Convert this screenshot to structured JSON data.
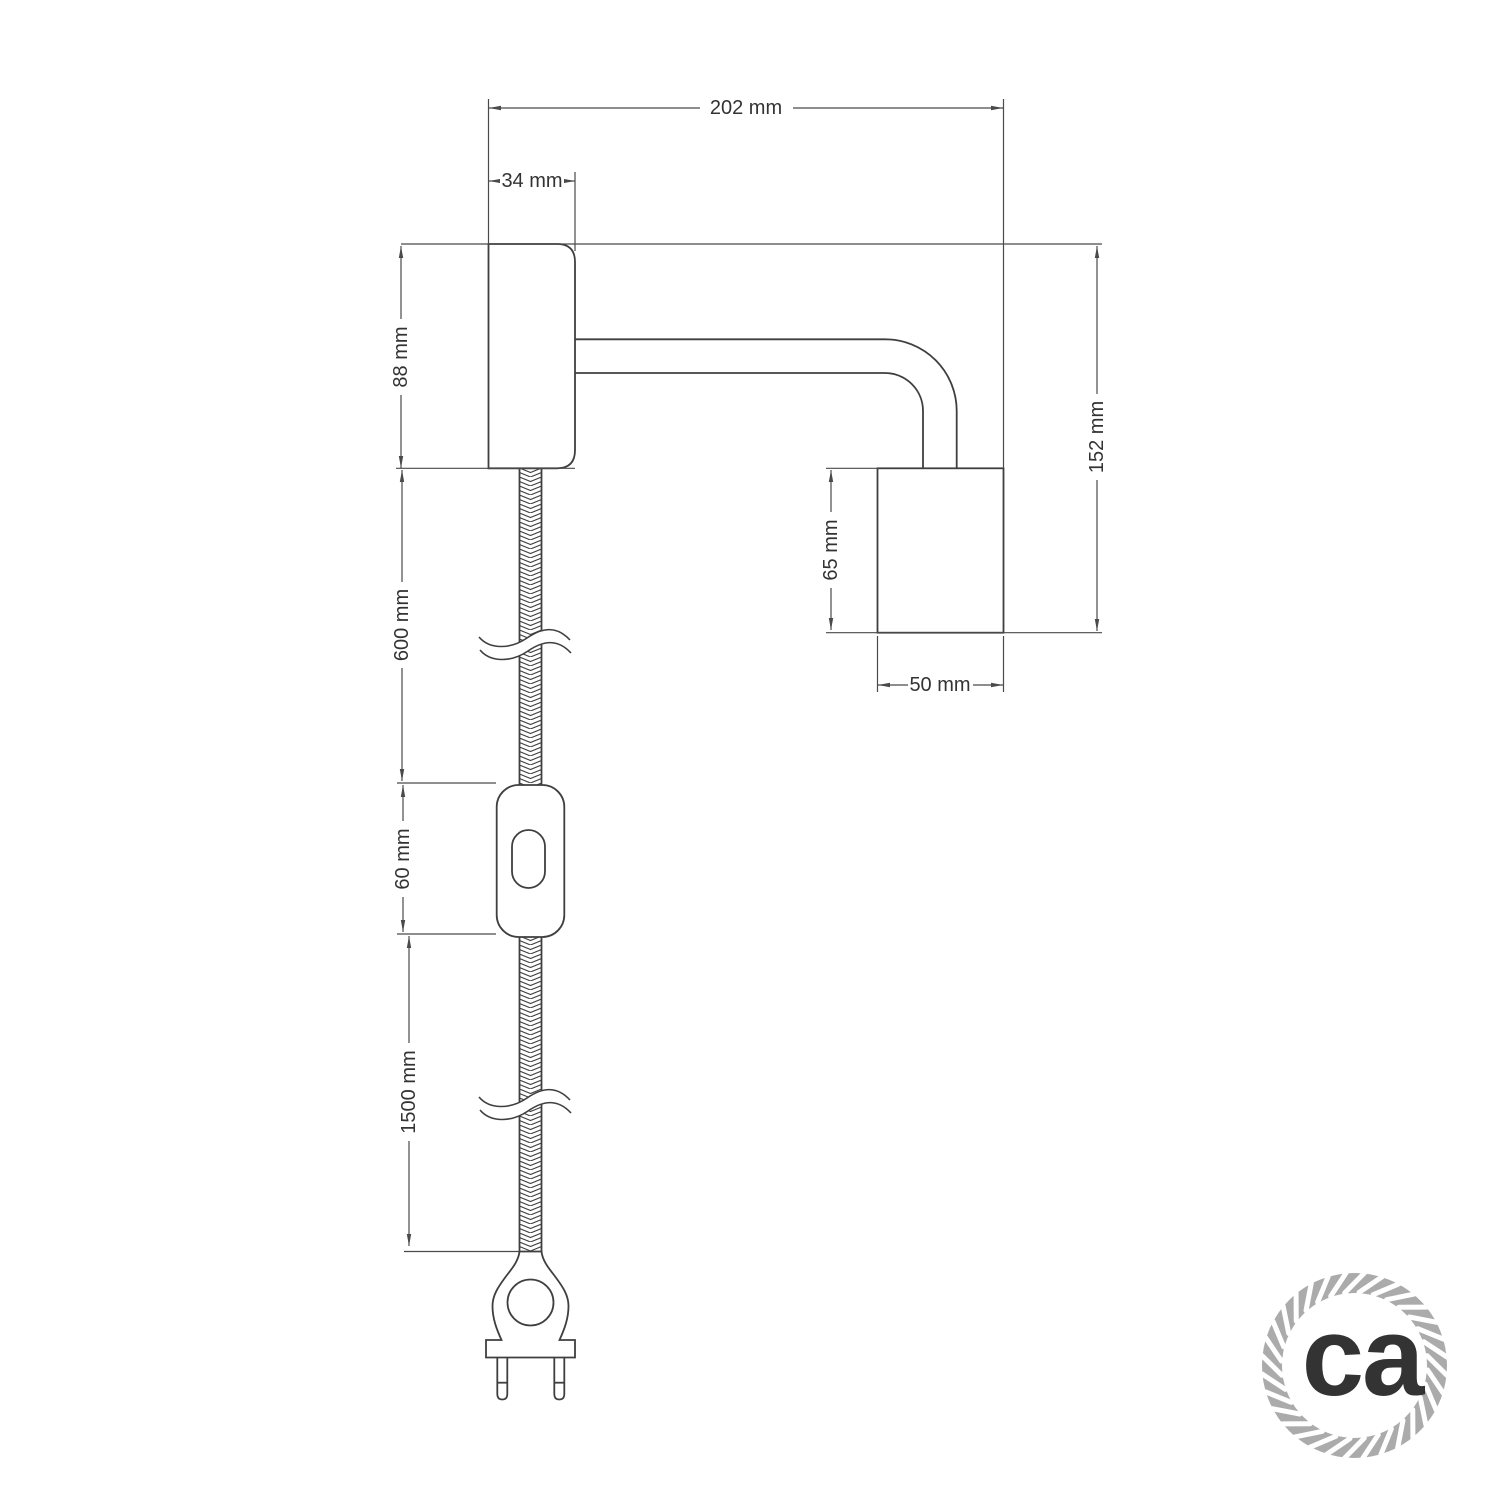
{
  "drawing": {
    "background": "#ffffff",
    "line_color": "#3f3f3f",
    "dimension_color": "#4a4a4a",
    "labels": {
      "overall_width": "202 mm",
      "mount_width": "34 mm",
      "mount_height": "88 mm",
      "overall_height": "152 mm",
      "socket_height": "65 mm",
      "socket_width": "50 mm",
      "cable_upper": "600 mm",
      "switch": "60 mm",
      "cable_lower": "1500 mm"
    },
    "logo": {
      "text": "ca",
      "color": "#a9a9a9",
      "ring_color": "#ababab"
    }
  }
}
